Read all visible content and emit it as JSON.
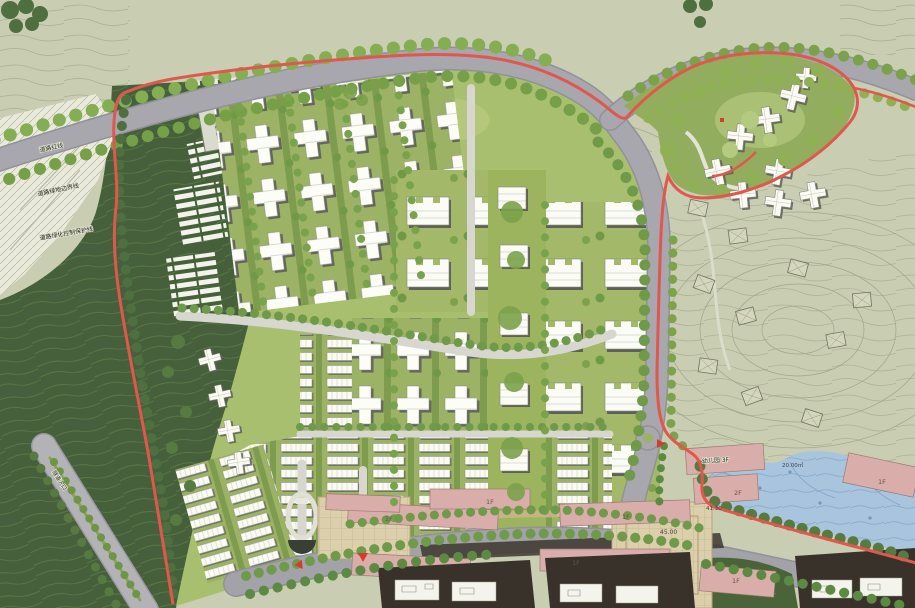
{
  "meta": {
    "kind": "residential-masterplan-site-plan-rendering",
    "canvas": {
      "width": 915,
      "height": 608
    }
  },
  "palette": {
    "offsite_sage": "#c9cdb2",
    "hill_dark_green": "#45603a",
    "meadow_green": "#a9bf70",
    "road_gray": "#a8a7ad",
    "site_boundary_red": "#e0574d",
    "water_blue": "#a9c4dd",
    "commercial_pink": "#d9aeaa",
    "plaza_tan": "#dccfac",
    "tree_green": "#7ca24b",
    "entry_marker_red": "#d93a2e"
  },
  "annotations": {
    "survey": [
      "道路红线",
      "道路绿地边界线",
      "道路绿化控制保护线"
    ],
    "tunnel_entry": "隧道入口",
    "kindergarten": "幼儿园 3F",
    "floor_2f": "2F",
    "elevations": {
      "plaza": "45.00",
      "building": "41.30"
    },
    "pond_area": "20.00㎡",
    "shops": [
      "1F",
      "1F",
      "1F",
      "1F",
      "1F",
      "1F"
    ]
  }
}
